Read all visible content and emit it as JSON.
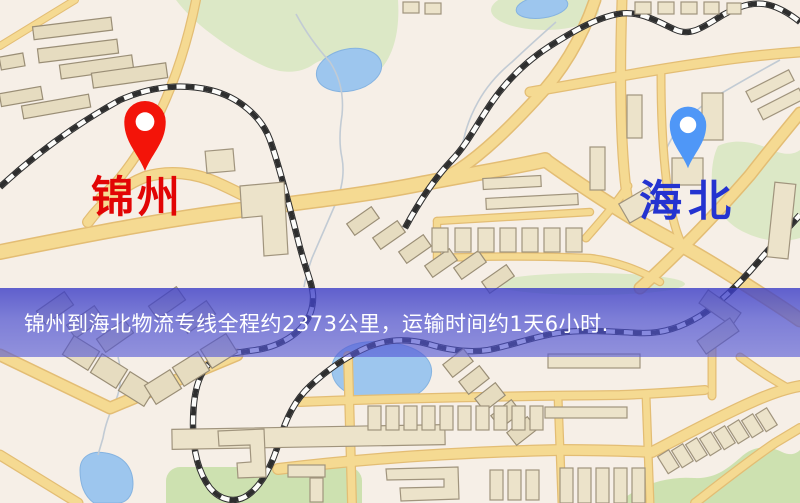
{
  "map": {
    "markers": {
      "origin": {
        "label": "锦州",
        "pin_color": "#f31409",
        "label_color": "#e20505"
      },
      "destination": {
        "label": "海北",
        "pin_color": "#4f97f7",
        "label_color": "#2433d0"
      }
    },
    "banner": {
      "text": "锦州到海北物流专线全程约2373公里，运输时间约1天6小时.",
      "text_color": "#ffffff",
      "overlay_color": "#4a4ec8"
    },
    "palette": {
      "background": "#f6efe7",
      "road": "#f5da92",
      "road_border": "#e3bd74",
      "building": "#ece3ca",
      "green": "#dce8c6",
      "water": "#9dc6ee",
      "railway": "#2e2e2e"
    }
  }
}
